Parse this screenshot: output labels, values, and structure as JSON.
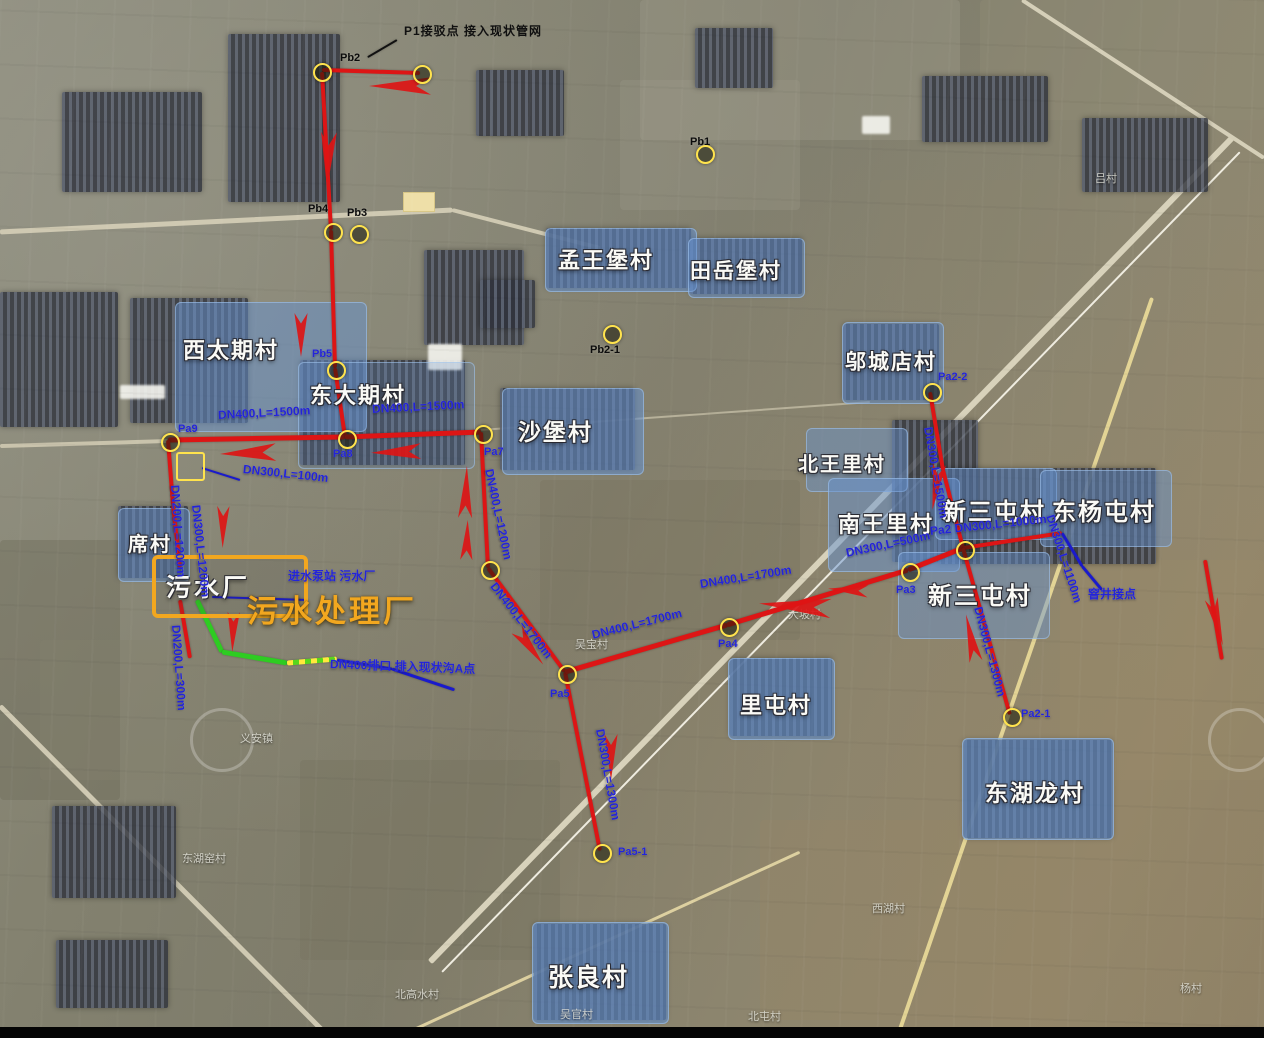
{
  "title": "污水管网布置卫星图",
  "colors": {
    "red": "#dd1515",
    "blue_line": "#1a1acc",
    "green": "#2ecc22",
    "yellow": "#ffe34d",
    "orange": "#f2a71f",
    "spec_blue": "#2324d8",
    "village_fill": "#6692d0",
    "black": "#111111"
  },
  "plant": {
    "inner_label": "污水厂",
    "title": "污水处理厂"
  },
  "notes": {
    "top_note": "P1接驳点 接入现状管网",
    "pump_note": "进水泵站 污水厂",
    "outfall_note": "DN400排口 排入现状沟A点",
    "manhole_note": "窨井接点"
  },
  "villages": [
    {
      "name": "西太期村",
      "x": 175,
      "y": 302,
      "w": 190,
      "h": 128,
      "lx": 183,
      "ly": 333,
      "fs": 22,
      "op": 0.5
    },
    {
      "name": "东大期村",
      "x": 298,
      "y": 362,
      "w": 175,
      "h": 105,
      "lx": 310,
      "ly": 378,
      "fs": 22,
      "op": 0.22
    },
    {
      "name": "沙堡村",
      "x": 502,
      "y": 388,
      "w": 140,
      "h": 85,
      "lx": 518,
      "ly": 413,
      "fs": 23,
      "op": 0.55
    },
    {
      "name": "孟王堡村",
      "x": 545,
      "y": 228,
      "w": 150,
      "h": 62,
      "lx": 558,
      "ly": 243,
      "fs": 22,
      "op": 0.55
    },
    {
      "name": "田岳堡村",
      "x": 688,
      "y": 238,
      "w": 115,
      "h": 58,
      "lx": 690,
      "ly": 255,
      "fs": 21,
      "op": 0.5
    },
    {
      "name": "邬城店村",
      "x": 842,
      "y": 322,
      "w": 100,
      "h": 80,
      "lx": 845,
      "ly": 346,
      "fs": 21,
      "op": 0.5
    },
    {
      "name": "北王里村",
      "x": 806,
      "y": 428,
      "w": 100,
      "h": 62,
      "lx": 798,
      "ly": 448,
      "fs": 20,
      "op": 0.45
    },
    {
      "name": "南王里村",
      "x": 828,
      "y": 478,
      "w": 130,
      "h": 92,
      "lx": 838,
      "ly": 507,
      "fs": 22,
      "op": 0.5
    },
    {
      "name": "新三屯村",
      "x": 935,
      "y": 468,
      "w": 120,
      "h": 70,
      "lx": 942,
      "ly": 492,
      "fs": 24,
      "op": 0.45
    },
    {
      "name": "东杨屯村",
      "x": 1040,
      "y": 470,
      "w": 130,
      "h": 75,
      "lx": 1052,
      "ly": 492,
      "fs": 24,
      "op": 0.45
    },
    {
      "name": "新三屯村",
      "x": 898,
      "y": 552,
      "w": 150,
      "h": 85,
      "lx": 928,
      "ly": 576,
      "fs": 24,
      "op": 0.45
    },
    {
      "name": "里屯村",
      "x": 728,
      "y": 658,
      "w": 105,
      "h": 80,
      "lx": 740,
      "ly": 688,
      "fs": 22,
      "op": 0.6
    },
    {
      "name": "东湖龙村",
      "x": 962,
      "y": 738,
      "w": 150,
      "h": 100,
      "lx": 985,
      "ly": 774,
      "fs": 23,
      "op": 0.6
    },
    {
      "name": "张良村",
      "x": 532,
      "y": 922,
      "w": 135,
      "h": 100,
      "lx": 548,
      "ly": 958,
      "fs": 25,
      "op": 0.6
    },
    {
      "name": "席村",
      "x": 118,
      "y": 508,
      "w": 70,
      "h": 72,
      "lx": 128,
      "ly": 528,
      "fs": 20,
      "op": 0.5
    }
  ],
  "minor_labels": [
    {
      "t": "大坡村",
      "x": 788,
      "y": 606
    },
    {
      "t": "义安镇",
      "x": 240,
      "y": 730
    },
    {
      "t": "东湖窑村",
      "x": 182,
      "y": 850
    },
    {
      "t": "北高水村",
      "x": 395,
      "y": 986
    },
    {
      "t": "吴官村",
      "x": 560,
      "y": 1006
    },
    {
      "t": "北屯村",
      "x": 748,
      "y": 1008
    },
    {
      "t": "西湖村",
      "x": 872,
      "y": 900
    },
    {
      "t": "杨村",
      "x": 1180,
      "y": 980
    },
    {
      "t": "吕村",
      "x": 1095,
      "y": 170
    },
    {
      "t": "吴宝村",
      "x": 575,
      "y": 636
    }
  ],
  "markers": [
    {
      "id": "Pb2",
      "x": 320,
      "y": 70,
      "label": "Pb2",
      "lx": 340,
      "ly": 52,
      "lc": "black"
    },
    {
      "id": "Pb2a",
      "x": 420,
      "y": 72,
      "label": "",
      "lx": 0,
      "ly": 0,
      "lc": "black"
    },
    {
      "id": "Pb4",
      "x": 331,
      "y": 230,
      "label": "Pb4",
      "lx": 308,
      "ly": 203,
      "lc": "black"
    },
    {
      "id": "Pb3",
      "x": 357,
      "y": 232,
      "label": "Pb3",
      "lx": 347,
      "ly": 207,
      "lc": "black"
    },
    {
      "id": "Pb5",
      "x": 334,
      "y": 368,
      "label": "Pb5",
      "lx": 312,
      "ly": 348,
      "lc": "blue"
    },
    {
      "id": "Pb1",
      "x": 703,
      "y": 152,
      "label": "Pb1",
      "lx": 690,
      "ly": 136,
      "lc": "black"
    },
    {
      "id": "Pb2-1",
      "x": 610,
      "y": 332,
      "label": "Pb2-1",
      "lx": 590,
      "ly": 344,
      "lc": "black"
    },
    {
      "id": "Pa9",
      "x": 168,
      "y": 440,
      "label": "Pa9",
      "lx": 178,
      "ly": 423,
      "lc": "blue"
    },
    {
      "id": "Pa8",
      "x": 345,
      "y": 437,
      "label": "Pa8",
      "lx": 333,
      "ly": 448,
      "lc": "blue"
    },
    {
      "id": "Pa7",
      "x": 481,
      "y": 432,
      "label": "Pa7",
      "lx": 484,
      "ly": 446,
      "lc": "blue"
    },
    {
      "id": "node-mid",
      "x": 488,
      "y": 568,
      "label": "",
      "lx": 0,
      "ly": 0,
      "lc": "blue"
    },
    {
      "id": "Pa5",
      "x": 565,
      "y": 672,
      "label": "Pa5",
      "lx": 550,
      "ly": 688,
      "lc": "blue"
    },
    {
      "id": "Pa5-1",
      "x": 600,
      "y": 851,
      "label": "Pa5-1",
      "lx": 618,
      "ly": 846,
      "lc": "blue"
    },
    {
      "id": "Pa4",
      "x": 727,
      "y": 625,
      "label": "Pa4",
      "lx": 718,
      "ly": 638,
      "lc": "blue"
    },
    {
      "id": "Pa3",
      "x": 908,
      "y": 570,
      "label": "Pa3",
      "lx": 896,
      "ly": 584,
      "lc": "blue"
    },
    {
      "id": "Pa2",
      "x": 963,
      "y": 548,
      "label": "",
      "lx": 0,
      "ly": 0,
      "lc": "blue"
    },
    {
      "id": "Pa2-2",
      "x": 930,
      "y": 390,
      "label": "Pa2-2",
      "lx": 938,
      "ly": 371,
      "lc": "blue"
    },
    {
      "id": "Pa2-1",
      "x": 1010,
      "y": 715,
      "label": "Pa2-1",
      "lx": 1021,
      "ly": 708,
      "lc": "blue"
    }
  ],
  "pipes": [
    [
      322,
      70,
      420,
      73,
      4,
      "red"
    ],
    [
      322,
      72,
      331,
      230,
      4,
      "red"
    ],
    [
      331,
      230,
      335,
      368,
      4,
      "red"
    ],
    [
      335,
      368,
      345,
      437,
      4,
      "red"
    ],
    [
      168,
      440,
      345,
      437,
      5,
      "red"
    ],
    [
      345,
      437,
      481,
      432,
      5,
      "red"
    ],
    [
      168,
      440,
      173,
      505,
      4,
      "red"
    ],
    [
      173,
      505,
      180,
      568,
      4,
      "red"
    ],
    [
      180,
      600,
      190,
      658,
      4,
      "red"
    ],
    [
      481,
      432,
      488,
      568,
      4,
      "red"
    ],
    [
      488,
      568,
      565,
      672,
      4,
      "red"
    ],
    [
      565,
      672,
      600,
      851,
      4,
      "red"
    ],
    [
      565,
      672,
      727,
      625,
      5,
      "red"
    ],
    [
      727,
      625,
      908,
      570,
      5,
      "red"
    ],
    [
      908,
      570,
      963,
      548,
      5,
      "red"
    ],
    [
      963,
      548,
      943,
      470,
      4,
      "red"
    ],
    [
      943,
      470,
      930,
      392,
      4,
      "red"
    ],
    [
      963,
      548,
      1062,
      533,
      4,
      "red"
    ],
    [
      963,
      548,
      1010,
      715,
      4,
      "red"
    ],
    [
      1205,
      560,
      1222,
      660,
      4,
      "red"
    ],
    [
      197,
      600,
      222,
      652,
      5,
      "green"
    ],
    [
      222,
      652,
      287,
      663,
      5,
      "green"
    ],
    [
      287,
      663,
      337,
      659,
      5,
      "dash"
    ],
    [
      337,
      660,
      392,
      669,
      3,
      "blue_line"
    ],
    [
      392,
      669,
      455,
      690,
      3,
      "blue_line"
    ],
    [
      202,
      468,
      240,
      480,
      2,
      "blue_line"
    ],
    [
      212,
      597,
      308,
      600,
      2,
      "blue_line"
    ],
    [
      1062,
      533,
      1082,
      566,
      3,
      "blue_line"
    ],
    [
      1082,
      566,
      1102,
      590,
      3,
      "blue_line"
    ],
    [
      397,
      40,
      368,
      57,
      2,
      "black"
    ]
  ],
  "pipe_labels": [
    {
      "t": "DN400,L=1500m",
      "x": 218,
      "y": 408,
      "r": -3
    },
    {
      "t": "DN400,L=1500m",
      "x": 372,
      "y": 402,
      "r": -3
    },
    {
      "t": "DN400,L=1200m",
      "x": 489,
      "y": 462,
      "r": 78
    },
    {
      "t": "DN400,L=1700m",
      "x": 493,
      "y": 577,
      "r": 52
    },
    {
      "t": "DN400,L=1700m",
      "x": 592,
      "y": 628,
      "r": -14
    },
    {
      "t": "DN400,L=1700m",
      "x": 700,
      "y": 577,
      "r": -9
    },
    {
      "t": "DN300,L=1300m",
      "x": 600,
      "y": 722,
      "r": 80
    },
    {
      "t": "DN300,L=500m",
      "x": 846,
      "y": 546,
      "r": -12
    },
    {
      "t": "Pa2 DN300,L=1000m",
      "x": 930,
      "y": 524,
      "r": -6
    },
    {
      "t": "DN300,L=1500m",
      "x": 928,
      "y": 420,
      "r": 80
    },
    {
      "t": "DN300,L=1300m",
      "x": 978,
      "y": 600,
      "r": 75
    },
    {
      "t": "DN300,L=1100m",
      "x": 1050,
      "y": 508,
      "r": 72
    },
    {
      "t": "DN200,L=1200m",
      "x": 175,
      "y": 478,
      "r": 86
    },
    {
      "t": "DN300,L=1200m",
      "x": 196,
      "y": 498,
      "r": 84
    },
    {
      "t": "DN200,L=300m",
      "x": 176,
      "y": 618,
      "r": 86
    },
    {
      "t": "DN300,L=100m",
      "x": 243,
      "y": 462,
      "r": 6
    },
    {
      "t": "进水泵站 污水厂",
      "x": 288,
      "y": 567,
      "r": 0
    },
    {
      "t": "DN400排口 排入现状沟A点",
      "x": 330,
      "y": 655,
      "r": 2
    },
    {
      "t": "窨井接点",
      "x": 1088,
      "y": 585,
      "r": 0
    }
  ],
  "arrows": [
    {
      "x": 400,
      "y": 86,
      "r": 180,
      "l": 62,
      "w": 20
    },
    {
      "x": 328,
      "y": 160,
      "r": 92,
      "l": 56,
      "w": 18
    },
    {
      "x": 301,
      "y": 335,
      "r": 90,
      "l": 44,
      "w": 15
    },
    {
      "x": 248,
      "y": 453,
      "r": 178,
      "l": 56,
      "w": 20
    },
    {
      "x": 396,
      "y": 452,
      "r": 178,
      "l": 50,
      "w": 18
    },
    {
      "x": 466,
      "y": 492,
      "r": -88,
      "l": 52,
      "w": 16
    },
    {
      "x": 467,
      "y": 540,
      "r": -88,
      "l": 40,
      "w": 14
    },
    {
      "x": 530,
      "y": 647,
      "r": 53,
      "l": 44,
      "w": 15
    },
    {
      "x": 611,
      "y": 757,
      "r": 90,
      "l": 46,
      "w": 15
    },
    {
      "x": 795,
      "y": 606,
      "r": 184,
      "l": 72,
      "w": 22
    },
    {
      "x": 848,
      "y": 590,
      "r": 184,
      "l": 40,
      "w": 14
    },
    {
      "x": 936,
      "y": 487,
      "r": 99,
      "l": 46,
      "w": 15
    },
    {
      "x": 971,
      "y": 638,
      "r": -102,
      "l": 48,
      "w": 15
    },
    {
      "x": 223,
      "y": 527,
      "r": 91,
      "l": 42,
      "w": 14
    },
    {
      "x": 233,
      "y": 632,
      "r": 92,
      "l": 40,
      "w": 14
    },
    {
      "x": 1217,
      "y": 622,
      "r": 76,
      "l": 48,
      "w": 15
    }
  ],
  "roads": [
    [
      0,
      232,
      452,
      210,
      5,
      "#cfc9b2"
    ],
    [
      452,
      210,
      600,
      248,
      4,
      "#cfc9b2"
    ],
    [
      430,
      962,
      1232,
      138,
      6,
      "#d8d2bb"
    ],
    [
      442,
      972,
      1240,
      152,
      2,
      "#efece0"
    ],
    [
      897,
      1038,
      1152,
      298,
      4,
      "#e3d495"
    ],
    [
      0,
      446,
      168,
      441,
      4,
      "#c9c3ac"
    ],
    [
      481,
      430,
      870,
      402,
      2,
      "#b7b19a"
    ],
    [
      0,
      706,
      330,
      1038,
      5,
      "#cfc9b2"
    ],
    [
      1022,
      0,
      1264,
      158,
      4,
      "#d5cfb8"
    ],
    [
      400,
      1036,
      800,
      852,
      3,
      "#ddd0a0"
    ]
  ],
  "clusters": [
    [
      228,
      34,
      112,
      168
    ],
    [
      62,
      92,
      140,
      100
    ],
    [
      0,
      292,
      118,
      135
    ],
    [
      130,
      298,
      118,
      125
    ],
    [
      300,
      360,
      165,
      105
    ],
    [
      500,
      388,
      135,
      82
    ],
    [
      546,
      228,
      145,
      60
    ],
    [
      690,
      238,
      112,
      56
    ],
    [
      476,
      70,
      88,
      66
    ],
    [
      695,
      28,
      78,
      60
    ],
    [
      922,
      76,
      126,
      66
    ],
    [
      1082,
      118,
      126,
      74
    ],
    [
      843,
      324,
      96,
      76
    ],
    [
      892,
      420,
      86,
      142
    ],
    [
      938,
      468,
      218,
      96
    ],
    [
      730,
      658,
      102,
      78
    ],
    [
      964,
      740,
      148,
      98
    ],
    [
      534,
      924,
      132,
      96
    ],
    [
      52,
      806,
      124,
      92
    ],
    [
      56,
      940,
      112,
      68
    ],
    [
      118,
      506,
      70,
      72
    ],
    [
      424,
      250,
      100,
      95
    ],
    [
      480,
      280,
      55,
      48
    ]
  ],
  "white_patches": [
    [
      120,
      385,
      45,
      14
    ],
    [
      428,
      344,
      34,
      26
    ],
    [
      862,
      116,
      28,
      18
    ]
  ],
  "fields": [
    [
      640,
      0,
      320,
      140,
      "rgba(160,158,140,.35)"
    ],
    [
      980,
      0,
      284,
      120,
      "rgba(145,140,118,.4)"
    ],
    [
      0,
      540,
      120,
      260,
      "rgba(110,108,92,.45)"
    ],
    [
      540,
      480,
      260,
      160,
      "rgba(120,116,96,.4)"
    ],
    [
      760,
      820,
      300,
      200,
      "rgba(150,134,102,.38)"
    ],
    [
      1060,
      560,
      204,
      220,
      "rgba(152,138,106,.4)"
    ],
    [
      300,
      760,
      260,
      200,
      "rgba(118,114,96,.4)"
    ],
    [
      620,
      80,
      180,
      130,
      "rgba(158,156,140,.3)"
    ],
    [
      40,
      640,
      200,
      140,
      "rgba(132,128,108,.35)"
    ],
    [
      880,
      180,
      220,
      120,
      "rgba(138,132,110,.35)"
    ]
  ],
  "watermarks": [
    [
      190,
      708,
      58
    ],
    [
      1208,
      708,
      58
    ]
  ]
}
